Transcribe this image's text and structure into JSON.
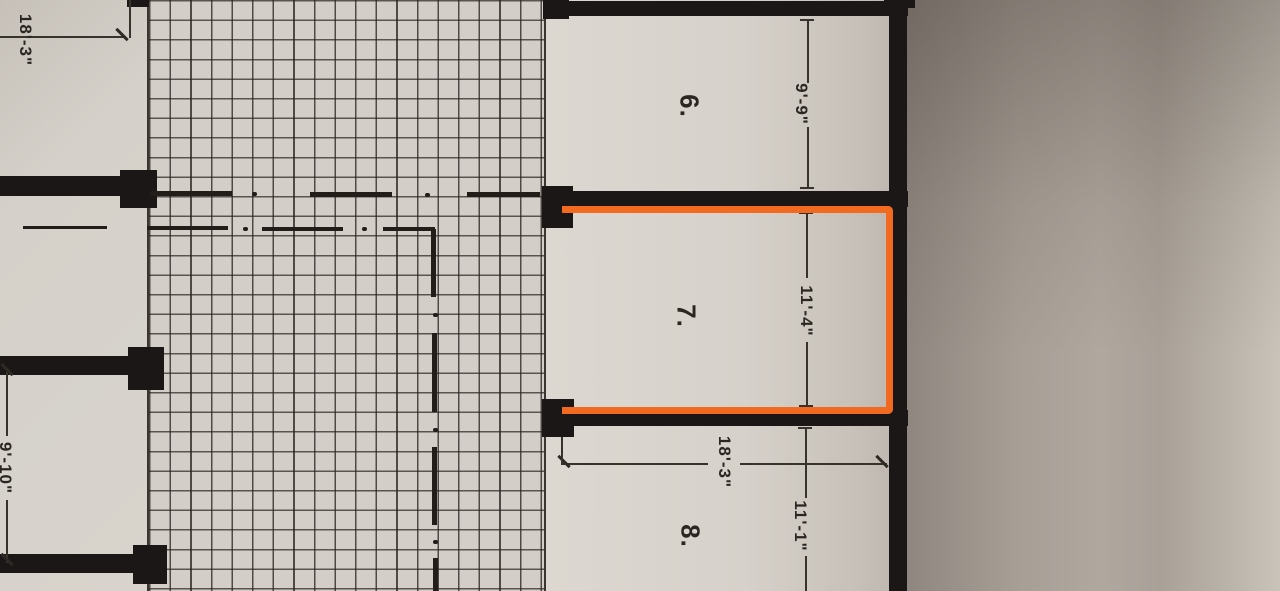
{
  "plan": {
    "type": "floor-plan-photo",
    "description": "Photograph of an architectural floor plan rotated 90 degrees; storage/parking units 6, 7, 8 open onto a tiled corridor; unit 7 is outlined with an orange highlight",
    "rooms": [
      {
        "number": "6.",
        "width": "9'-9\"",
        "highlighted": false
      },
      {
        "number": "7.",
        "width": "11'-4\"",
        "highlighted": true
      },
      {
        "number": "8.",
        "width": "11'-1\"",
        "depth": "18'-3\"",
        "highlighted": false
      }
    ],
    "left_dimensions": {
      "top": "18'-3\"",
      "bottom": "9'-10\""
    },
    "colors": {
      "highlight": "#F26A1F",
      "wall": "#1B1716",
      "paper_light": "#D6D2CB",
      "paper_shadow": "#8F877F",
      "grid_line": "#2A2420"
    }
  }
}
